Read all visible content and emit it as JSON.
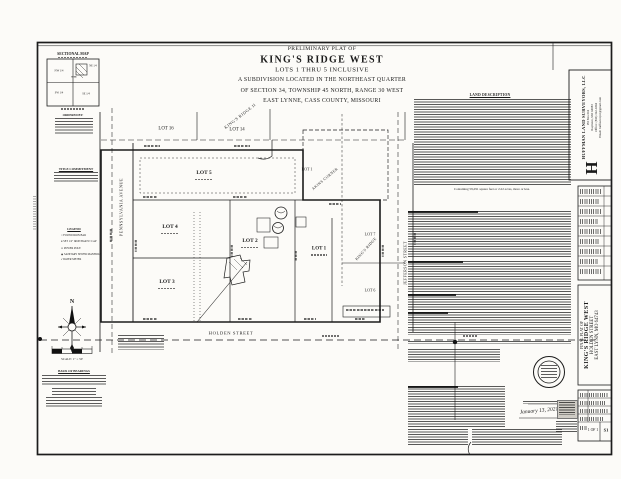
{
  "colors": {
    "paper": "#fcfbf8",
    "ink": "#1a1a1a"
  },
  "header": {
    "pre_title": "PRELIMINARY PLAT OF",
    "title": "KING'S RIDGE WEST",
    "subtitle1": "LOTS 1 THRU 5 INCLUSIVE",
    "subtitle2": "A SUBDIVISION LOCATED IN THE NORTHEAST QUARTER",
    "subtitle3": "OF SECTION 34, TOWNSHIP 45 NORTH, RANGE 30 WEST",
    "subtitle4": "EAST LYNNE, CASS COUNTY, MISSOURI"
  },
  "sectional_map": {
    "title": "SECTIONAL MAP",
    "nw": "NW 1/4",
    "ne": "NE 1/4",
    "sw": "SW 1/4",
    "se": "SE 1/4",
    "site": "SITE",
    "ordered_by": "ORDERED BY:"
  },
  "title_commitment_heading": "TITLE COMMITMENT",
  "legend": {
    "heading": "LEGEND",
    "items": [
      {
        "icon": "found-iron-bar-icon",
        "glyph": "○",
        "label": "FOUND IRON BAR"
      },
      {
        "icon": "set-iron-bar-icon",
        "glyph": "●",
        "label": "SET 1/2\" IRON BAR W/ CAP"
      },
      {
        "icon": "power-pole-icon",
        "glyph": "⊙",
        "label": "POWER POLE"
      },
      {
        "icon": "sewer-manhole-icon",
        "glyph": "◉",
        "label": "SANITARY SEWER MANHOLE"
      },
      {
        "icon": "water-meter-icon",
        "glyph": "▪",
        "label": "WATER METER"
      }
    ]
  },
  "compass_north": "N",
  "scale_label": "SCALE: 1\" = 50'",
  "basis_of_bearings_heading": "BASIS OF BEARINGS",
  "plat": {
    "streets": {
      "west": "PENNSYLVANIA AVENUE",
      "east": "JEFFERSON STREET",
      "south": "HOLDEN STREET"
    },
    "subdivisions": {
      "north": "KING'S RIDGE II",
      "northeast": "AKINS CORNER",
      "east": "KING'S RIDGE"
    },
    "adjacent_lots": {
      "lot16": "LOT 16",
      "lot14": "LOT 14",
      "akins_lot1": "LOT 1",
      "kr_lot7": "LOT 7",
      "kr_lot6": "LOT 6"
    },
    "lots": {
      "lot5": "LOT 5",
      "lot4": "LOT 4",
      "lot3": "LOT 3",
      "lot2": "LOT 2",
      "lot1": "LOT 1"
    }
  },
  "land_description": {
    "heading": "LAND DESCRIPTION",
    "containing_line": "Containing 59,291 square feet or 2.22 acres, more or less."
  },
  "surveyor_signature_date": "January 13, 2021",
  "panel": {
    "logo_letter": "H",
    "company": "HUFFMAN LAND SURVEYORS, LLC",
    "address": "PO Box 661",
    "city": "Raymore, MO 64083",
    "phone": "Office: (816) 322-4344",
    "email": "Email: huffsurveyor@gmail.com",
    "project": {
      "line1": "FINAL PLAT OF",
      "line2": "KING'S RIDGE WEST",
      "line3": "HOLDEN STREET",
      "line4": "EAST LYNN, MO 64743"
    },
    "sheet_value": "1 OF 1",
    "sheet_code": "S1"
  }
}
